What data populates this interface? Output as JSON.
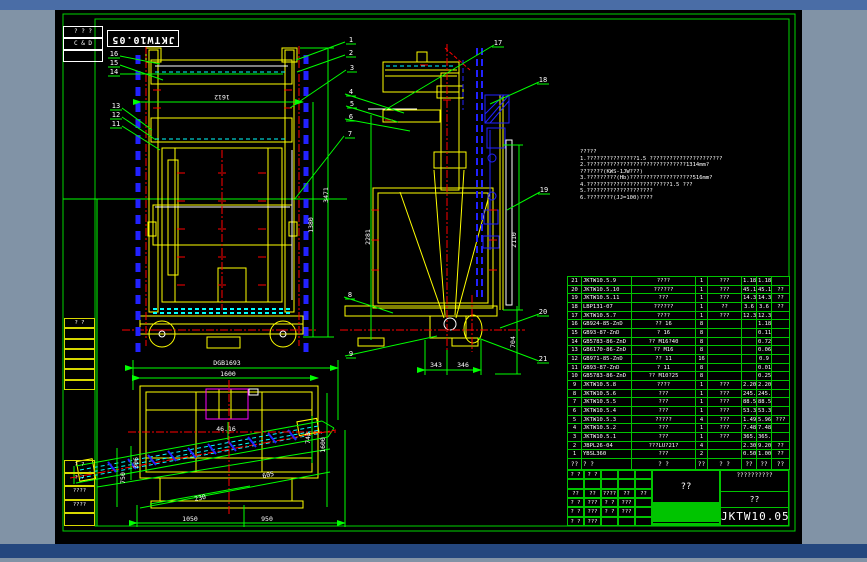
{
  "sheet": {
    "top_title": "JKTW10.05",
    "corner_rows": [
      "? ? ?",
      "C & D",
      ""
    ]
  },
  "left_strip": {
    "upper_rows": [
      "? ?",
      "",
      "",
      "",
      "",
      "",
      ""
    ],
    "bottom_rows": [
      "? ?",
      "? ?",
      "????",
      "????",
      ""
    ]
  },
  "notes": {
    "lines": [
      "?????",
      "1.???????????????1.5 ??????????????????????",
      "2.??????????????????????????????1314mm?",
      "  ???????(KWS-1JW???)",
      "3.?????????(Hb)???????????????????516mm?",
      "4.?????????????????????????1.5 ???",
      "5.????????????????????",
      "6.????????(JJ=100)????"
    ]
  },
  "dims": {
    "front_width": "1612",
    "front_h1": "1380",
    "front_h2": "3471",
    "side_h": "2281",
    "side_rail": "2110",
    "base_left": "343",
    "base_right": "346",
    "base_h": "704",
    "plan_total": "DGB1693",
    "plan_width": "1600",
    "plan_b1": "1050",
    "plan_b2": "950",
    "plan_left1": "750",
    "plan_left2": "306",
    "plan_mid": "46.16",
    "plan_r1": "743",
    "plan_r2": "1600",
    "plan_d1": "605",
    "plan_d2": "230"
  },
  "balloons": [
    "1",
    "2",
    "3",
    "4",
    "5",
    "6",
    "7",
    "8",
    "9",
    "10",
    "11",
    "12",
    "13",
    "14",
    "15",
    "16",
    "17",
    "18",
    "19",
    "20",
    "21"
  ],
  "bom": {
    "header": [
      "??",
      "? ?",
      "? ?",
      "??",
      "? ?",
      "??",
      "??",
      "??"
    ],
    "rows": [
      [
        "21",
        "JKTW10.5.9",
        "????",
        "1",
        "???",
        "1.18",
        "1.18",
        ""
      ],
      [
        "20",
        "JKTW10.5.10",
        "??????",
        "1",
        "???",
        "45.16",
        "45.16",
        "??"
      ],
      [
        "19",
        "JKTW10.5.11",
        "???",
        "1",
        "???",
        "14.3",
        "14.3",
        "??"
      ],
      [
        "18",
        "LBP131-07",
        "??????",
        "1",
        "??",
        "3.6",
        "3.6",
        "??"
      ],
      [
        "17",
        "JKTW10.5.7",
        "????",
        "1",
        "???",
        "12.3",
        "12.3",
        ""
      ],
      [
        "16",
        "GB924-85-ZnD",
        "?? 16",
        "8",
        "",
        "",
        "1.18",
        ""
      ],
      [
        "15",
        "GB93-87-ZnD",
        "? 16",
        "8",
        "",
        "",
        "0.11",
        ""
      ],
      [
        "14",
        "GB5783-86-ZnD",
        "?? M16?40",
        "8",
        "",
        "",
        "0.72",
        ""
      ],
      [
        "13",
        "GB6170-86-ZnD",
        "?? M16",
        "8",
        "",
        "",
        "0.06",
        ""
      ],
      [
        "12",
        "GB971-85-ZnD",
        "?? 11",
        "16",
        "",
        "",
        "0.9",
        ""
      ],
      [
        "11",
        "GB93-87-ZnD",
        "? 11",
        "8",
        "",
        "",
        "0.01",
        ""
      ],
      [
        "10",
        "GB5783-86-ZnD",
        "?? M10?25",
        "8",
        "",
        "",
        "0.25",
        ""
      ],
      [
        "9",
        "JKTW10.5.8",
        "????",
        "1",
        "???",
        "2.20",
        "2.20",
        ""
      ],
      [
        "8",
        "JKTW10.5.6",
        "???",
        "1",
        "???",
        "245.19",
        "245.19",
        ""
      ],
      [
        "7",
        "JKTW10.5.5",
        "???",
        "1",
        "???",
        "88.54",
        "88.54",
        ""
      ],
      [
        "6",
        "JKTW10.5.4",
        "???",
        "1",
        "???",
        "53.35",
        "53.35",
        ""
      ],
      [
        "5",
        "JKTW10.5.3",
        "?????",
        "4",
        "???",
        "1.49",
        "5.96",
        "???"
      ],
      [
        "4",
        "JKTW10.5.2",
        "???",
        "1",
        "???",
        "7.48",
        "7.48",
        ""
      ],
      [
        "3",
        "JKTW10.5.1",
        "???",
        "1",
        "???",
        "365.4",
        "365.4",
        ""
      ],
      [
        "2",
        "JBPL26-04",
        "???LU?21?",
        "4",
        "",
        "2.30",
        "9.20",
        "??"
      ],
      [
        "1",
        "YBSL360",
        "???",
        "2",
        "",
        "0.50",
        "1.00",
        "??"
      ]
    ]
  },
  "title_block": {
    "company": "??????????",
    "project": "??",
    "big_label": "??",
    "drawing_no": "JKTW10.05",
    "left_grid": [
      [
        "? ?",
        "? ?",
        "",
        "",
        ""
      ],
      [
        "",
        "",
        "",
        "",
        ""
      ],
      [
        "??",
        "??",
        "????",
        "??",
        "??"
      ],
      [
        "? ?",
        "???",
        "? ?",
        "???",
        ""
      ],
      [
        "? ?",
        "???",
        "? ?",
        "???",
        ""
      ],
      [
        "? ?",
        "???",
        "",
        "",
        ""
      ]
    ],
    "mid_top": [
      "???",
      "??",
      "??",
      "??"
    ],
    "mid_cells": [
      "S",
      "A",
      "",
      "",
      "N?N",
      "Hb"
    ],
    "mid_bottom": [
      "?",
      "?",
      "?"
    ]
  }
}
